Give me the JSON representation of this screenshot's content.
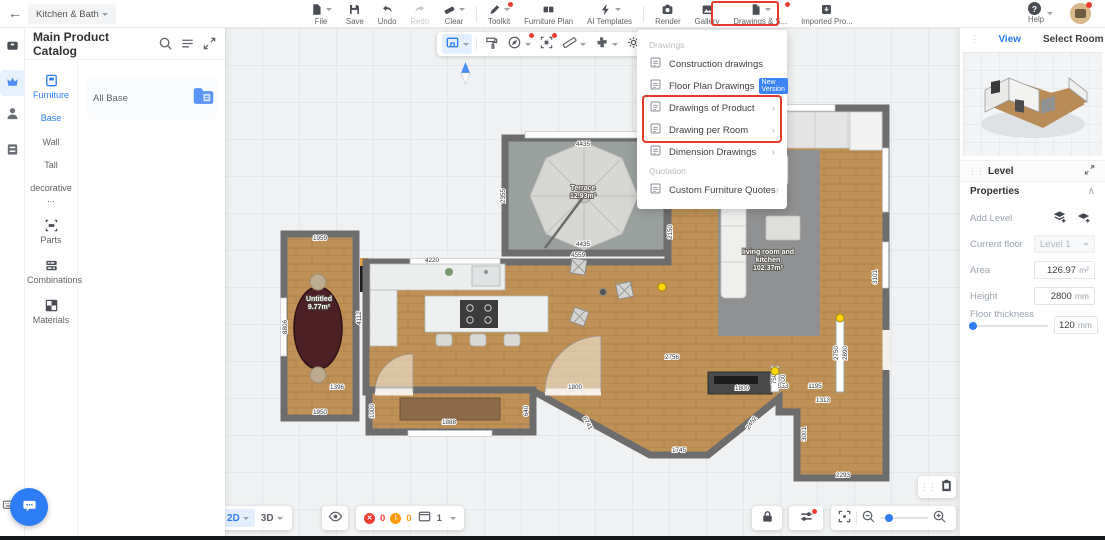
{
  "topbar": {
    "project_selector": "Kitchen & Bath",
    "tools": [
      {
        "label": "File",
        "icon": "file",
        "caret": true
      },
      {
        "label": "Save",
        "icon": "save"
      },
      {
        "label": "Undo",
        "icon": "undo"
      },
      {
        "label": "Redo",
        "icon": "redo",
        "disabled": true
      },
      {
        "label": "Clear",
        "icon": "clear",
        "caret": true
      },
      {
        "divider": true
      },
      {
        "label": "Toolkit",
        "icon": "toolkit",
        "dot": true,
        "caret": true
      },
      {
        "label": "Furniture Plan",
        "icon": "furniture-plan"
      },
      {
        "label": "AI Templates",
        "icon": "ai",
        "caret": true
      },
      {
        "divider": true
      },
      {
        "label": "Render",
        "icon": "render"
      },
      {
        "label": "Gallery",
        "icon": "gallery"
      },
      {
        "label": "Drawings & S...",
        "icon": "drawings",
        "dot": true,
        "caret": true,
        "highlighted": true
      },
      {
        "label": "Imported Pro...",
        "icon": "imported"
      }
    ],
    "help_label": "Help"
  },
  "catalog": {
    "title": "Main Product Catalog",
    "tabs": [
      {
        "label": "Furniture",
        "icon": "furniture-tab",
        "active": true
      },
      {
        "label": "Base",
        "blue": true
      },
      {
        "label": "Wall"
      },
      {
        "label": "Tall"
      },
      {
        "label": "decorative ..."
      },
      {
        "label": "Parts",
        "icon": "parts"
      },
      {
        "label": "Combinations",
        "icon": "combinations"
      },
      {
        "label": "Materials",
        "icon": "materials"
      }
    ],
    "all_base_label": "All Base"
  },
  "canvas_toolbar": {
    "buttons": [
      {
        "name": "room-tool",
        "active": true,
        "caret": true
      },
      {
        "divider": true
      },
      {
        "name": "paint-roller"
      },
      {
        "name": "compass",
        "dot": true,
        "caret": true
      },
      {
        "name": "magic-select",
        "dot": true
      },
      {
        "name": "ruler",
        "caret": true
      },
      {
        "name": "plugin",
        "caret": true
      },
      {
        "name": "settings",
        "caret": true
      }
    ]
  },
  "drawings_menu": {
    "sections": [
      {
        "header": "Drawings",
        "items": [
          {
            "label": "Construction drawings"
          },
          {
            "label": "Floor Plan Drawings",
            "badge": "New Version"
          },
          {
            "label": "Drawings of Product",
            "submenu": true,
            "highlighted": true
          },
          {
            "label": "Drawing per Room",
            "submenu": true,
            "highlighted": true
          },
          {
            "label": "Dimension Drawings",
            "submenu": true
          }
        ]
      },
      {
        "header": "Quotation",
        "items": [
          {
            "label": "Custom Furniture Quotes",
            "submenu": true
          }
        ]
      }
    ]
  },
  "floorplan": {
    "rooms": [
      {
        "lines": [
          "Terrace",
          "12.93m²"
        ],
        "x": 583,
        "y": 190
      },
      {
        "lines": [
          "Untitled",
          "9.77m²"
        ],
        "x": 319,
        "y": 301
      },
      {
        "lines": [
          "living room and",
          "kitchen",
          "102.37m²"
        ],
        "x": 768,
        "y": 254
      }
    ],
    "dimensions": [
      {
        "t": "4435",
        "x": 583,
        "y": 146
      },
      {
        "t": "4435",
        "x": 583,
        "y": 246
      },
      {
        "t": "4559",
        "x": 578,
        "y": 257
      },
      {
        "t": "2355",
        "x": 505,
        "y": 196,
        "r": -90
      },
      {
        "t": "2150",
        "x": 672,
        "y": 232,
        "r": -90
      },
      {
        "t": "4220",
        "x": 432,
        "y": 262
      },
      {
        "t": "1959",
        "x": 320,
        "y": 240
      },
      {
        "t": "1950",
        "x": 320,
        "y": 414
      },
      {
        "t": "8806",
        "x": 287,
        "y": 327,
        "r": -90
      },
      {
        "t": "4112",
        "x": 361,
        "y": 318,
        "r": -90
      },
      {
        "t": "1396",
        "x": 337,
        "y": 389
      },
      {
        "t": "1000",
        "x": 374,
        "y": 411,
        "r": -90
      },
      {
        "t": "1888",
        "x": 449,
        "y": 424
      },
      {
        "t": "640",
        "x": 528,
        "y": 411,
        "r": -90
      },
      {
        "t": "1800",
        "x": 575,
        "y": 389
      },
      {
        "t": "6741",
        "x": 586,
        "y": 424,
        "r": 62
      },
      {
        "t": "1745",
        "x": 679,
        "y": 452
      },
      {
        "t": "2452",
        "x": 753,
        "y": 424,
        "r": -56
      },
      {
        "t": "2756",
        "x": 672,
        "y": 359
      },
      {
        "t": "1800",
        "x": 742,
        "y": 390
      },
      {
        "t": "533",
        "x": 783,
        "y": 388
      },
      {
        "t": "1195",
        "x": 815,
        "y": 388
      },
      {
        "t": "1313",
        "x": 823,
        "y": 402
      },
      {
        "t": "750",
        "x": 776,
        "y": 379,
        "r": -90
      },
      {
        "t": "700",
        "x": 785,
        "y": 380,
        "r": -90
      },
      {
        "t": "2750",
        "x": 838,
        "y": 353,
        "r": -90
      },
      {
        "t": "2890",
        "x": 847,
        "y": 353,
        "r": -90
      },
      {
        "t": "3101",
        "x": 877,
        "y": 277,
        "r": -90
      },
      {
        "t": "3001",
        "x": 806,
        "y": 434,
        "r": -90
      },
      {
        "t": "2293",
        "x": 843,
        "y": 477
      }
    ],
    "markers": [
      {
        "x": 840,
        "y": 318
      },
      {
        "x": 775,
        "y": 371
      },
      {
        "x": 662,
        "y": 287
      }
    ]
  },
  "bottom_bar": {
    "mode_2d": "2D",
    "mode_3d": "3D",
    "error_count": "0",
    "warning_count": "0",
    "view_count": "1"
  },
  "right_panel": {
    "tabs": {
      "view": "View",
      "select_room": "Select Room"
    },
    "level": {
      "title": "Level",
      "properties_label": "Properties",
      "add_level_label": "Add Level",
      "current_floor_label": "Current floor",
      "current_floor_value": "Level 1",
      "area_label": "Area",
      "area_value": "126.97",
      "area_unit": "m²",
      "height_label": "Height",
      "height_value": "2800",
      "height_unit": "mm",
      "thickness_label": "Floor thickness",
      "thickness_value": "120",
      "thickness_unit": "mm"
    }
  },
  "colors": {
    "accent_blue": "#2f7df6",
    "highlight_red": "#e8392b",
    "error_red": "#f23c32",
    "warning_orange": "#ff9a0e",
    "marker_yellow": "#ffd60a"
  }
}
